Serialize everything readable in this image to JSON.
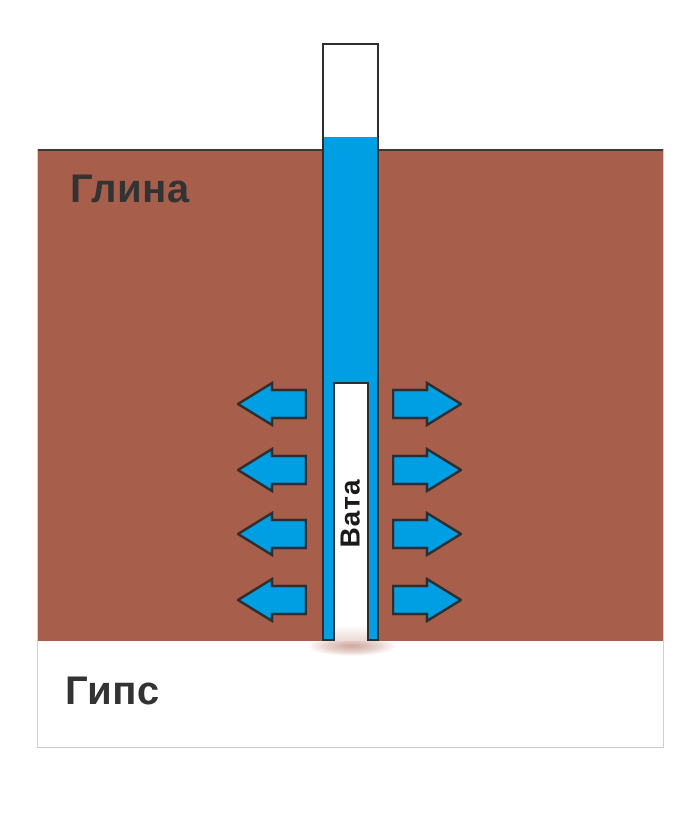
{
  "diagram": {
    "layers": [
      {
        "id": "clay",
        "label": "Глина"
      },
      {
        "id": "gypsum",
        "label": "Гипс"
      }
    ],
    "tube": {
      "plug_label": "Вата"
    },
    "arrows": {
      "rows": 4,
      "directions": [
        "left",
        "right"
      ]
    },
    "colors": {
      "clay_brown": "#A75E4B",
      "water_blue": "#009FE3",
      "outline_dark": "#2E2E2E",
      "label_text": "#333333",
      "light_border": "#CFCFCF"
    }
  }
}
